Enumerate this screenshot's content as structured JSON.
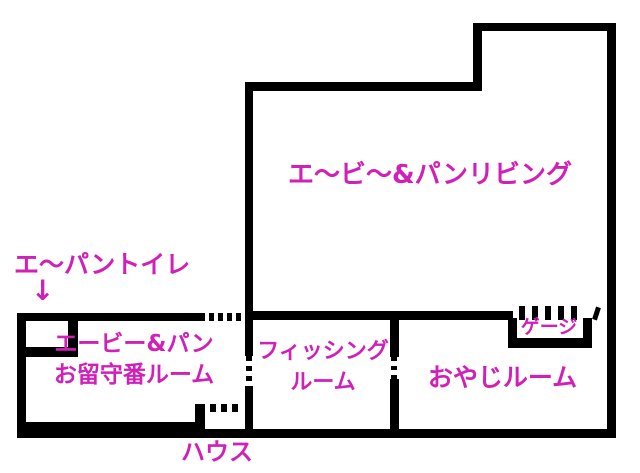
{
  "colors": {
    "wall": "#000000",
    "background": "#ffffff",
    "label": "#d020b8"
  },
  "rooms": {
    "living": {
      "label": "エ〜ビ〜&パンリビング"
    },
    "toilet": {
      "label": "エ〜パントイレ",
      "arrow_down": "↓"
    },
    "absence": {
      "label_line1": "エービー&パン",
      "label_line2": "お留守番ルーム"
    },
    "fishing": {
      "label_line1": "フィッシング",
      "label_line2": "ルーム"
    },
    "oyaji": {
      "label": "おやじルーム"
    },
    "cage": {
      "label": "ゲージ"
    },
    "house": {
      "label": "ハウス"
    }
  }
}
